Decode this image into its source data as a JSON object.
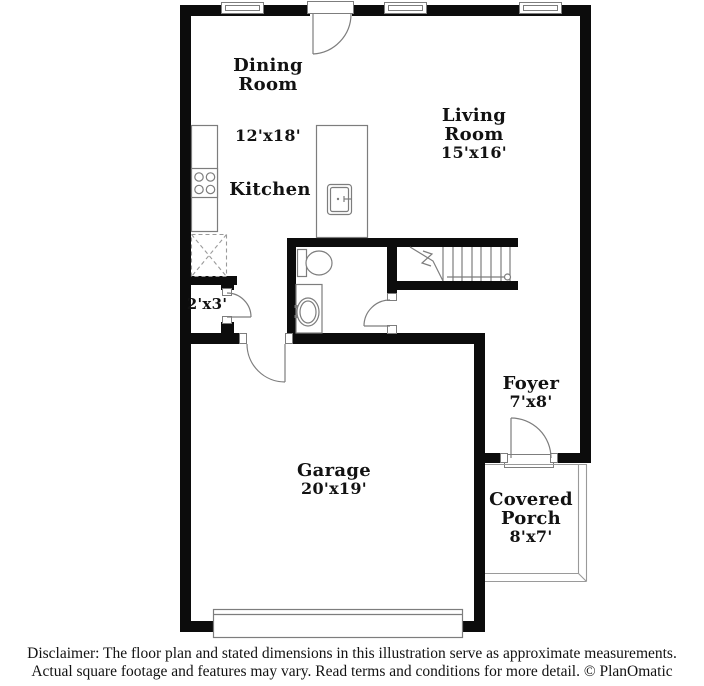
{
  "page": {
    "width": 704,
    "height": 686,
    "background": "#ffffff"
  },
  "colors": {
    "wall": "#0c0c0c",
    "line": "#7d7d7d",
    "line_light": "#9a9a9a",
    "text": "#121212"
  },
  "rooms": {
    "dining": {
      "name": "Dining Room",
      "dims": "12'x18'"
    },
    "kitchen": {
      "name": "Kitchen"
    },
    "living": {
      "name": "Living Room",
      "dims": "15'x16'"
    },
    "closet": {
      "dims": "2'x3'"
    },
    "garage": {
      "name": "Garage",
      "dims": "20'x19'"
    },
    "foyer": {
      "name": "Foyer",
      "dims": "7'x8'"
    },
    "porch": {
      "name": "Covered Porch",
      "dims": "8'x7'"
    }
  },
  "fixtures": [
    "staircase",
    "toilet",
    "vanity-sink",
    "kitchen-counter",
    "stove",
    "refrigerator",
    "kitchen-island",
    "island-sink",
    "garage-door",
    "front-door",
    "back-door",
    "closet-door",
    "bathroom-door",
    "garage-hall-door",
    "windows",
    "covered-porch-outline"
  ],
  "disclaimer": {
    "line1": "Disclaimer: The floor plan and stated dimensions in this illustration serve as approximate measurements.",
    "line2": "Actual square footage and features may vary. Read terms and conditions for more detail. © PlanOmatic"
  }
}
